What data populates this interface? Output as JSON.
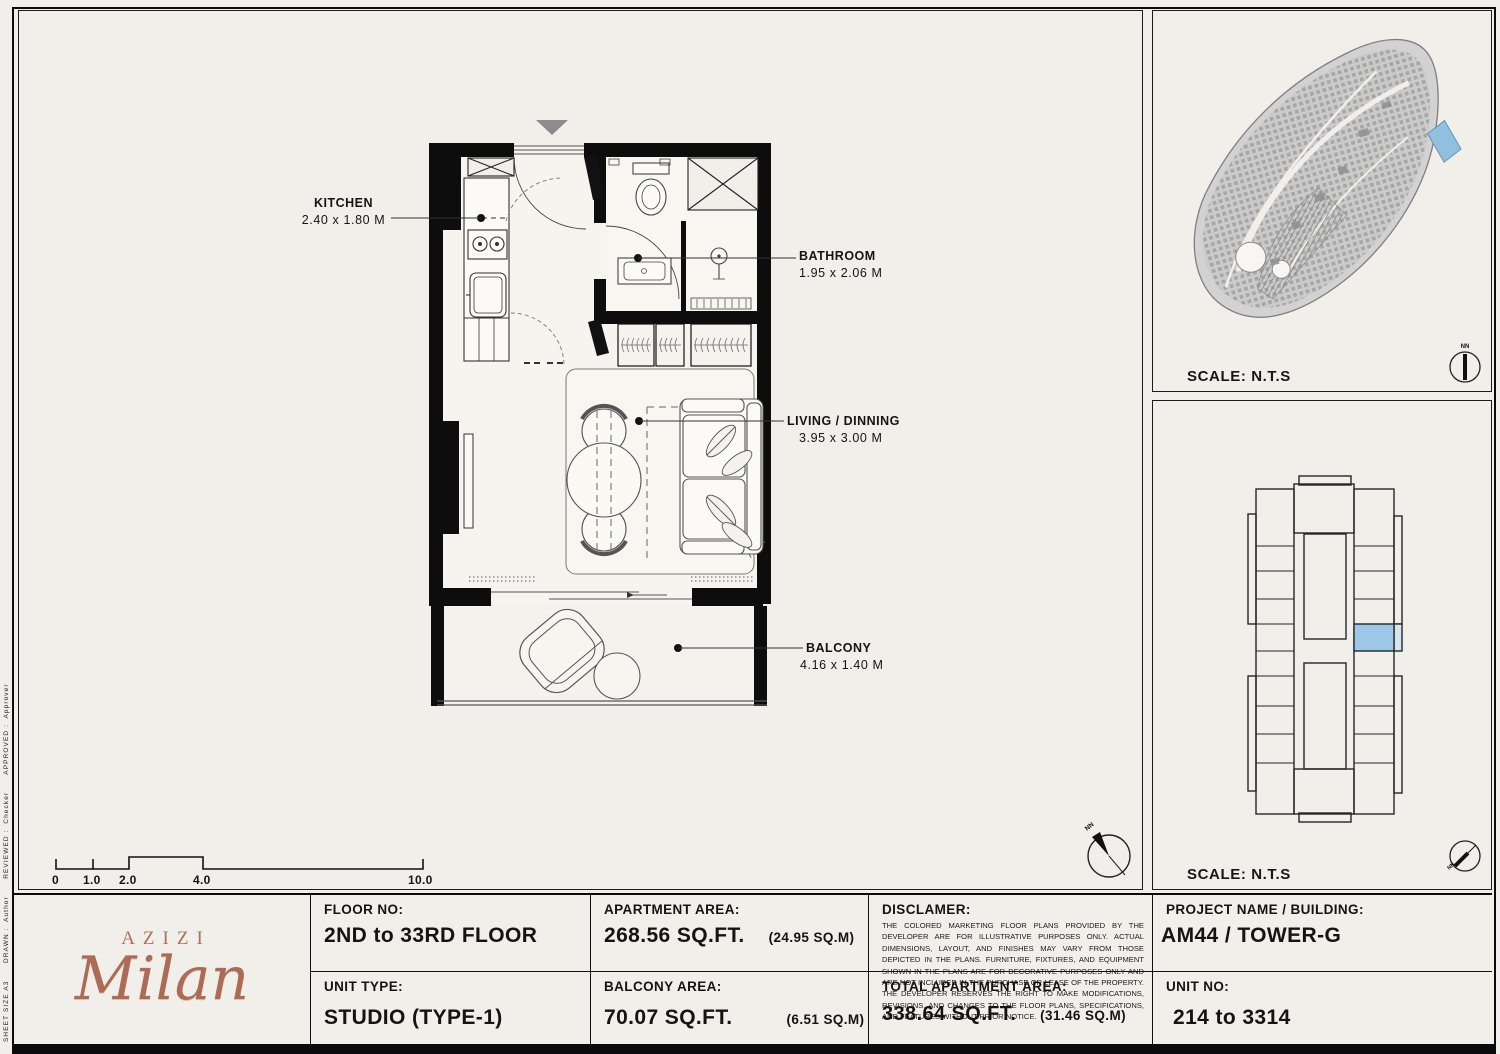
{
  "sheet": {
    "side_note": "SHEET SIZE A3      DRAWN :  Author      REVIEWED :  Checker      APPROVED :  Approver"
  },
  "plan": {
    "callouts": [
      {
        "name": "KITCHEN",
        "dims": "2.40 x 1.80 M"
      },
      {
        "name": "BATHROOM",
        "dims": "1.95 x 2.06 M"
      },
      {
        "name": "LIVING / DINNING",
        "dims": "3.95 x 3.00 M"
      },
      {
        "name": "BALCONY",
        "dims": "4.16 x 1.40 M"
      }
    ],
    "scale_bar": {
      "ticks": [
        "0",
        "1.0",
        "2.0",
        "4.0",
        "10.0"
      ]
    },
    "compass_label": "NN"
  },
  "site_plan": {
    "scale_label": "SCALE: N.T.S",
    "compass_label": "NN",
    "highlight_color": "#8fc0e0"
  },
  "key_plan": {
    "scale_label": "SCALE: N.T.S",
    "compass_label": "NN",
    "highlight_color": "#9dc8e8"
  },
  "title_block": {
    "logo": {
      "brand": "AZIZI",
      "name": "Milan"
    },
    "floor": {
      "label": "FLOOR NO:",
      "value": "2ND to 33RD FLOOR"
    },
    "unit_type": {
      "label": "UNIT TYPE:",
      "value": "STUDIO (TYPE-1)"
    },
    "apartment_area": {
      "label": "APARTMENT AREA:",
      "value": "268.56 SQ.FT.",
      "metric": "(24.95 SQ.M)"
    },
    "balcony_area": {
      "label": "BALCONY AREA:",
      "value": "70.07 SQ.FT.",
      "metric": "(6.51 SQ.M)"
    },
    "disclaimer": {
      "label": "DISCLAMER:",
      "text": "THE COLORED MARKETING FLOOR PLANS PROVIDED BY THE DEVELOPER ARE FOR ILLUSTRATIVE PURPOSES ONLY. ACTUAL DIMENSIONS, LAYOUT, AND FINISHES MAY VARY FROM THOSE DEPICTED IN THE PLANS. FURNITURE, FIXTURES, AND EQUIPMENT SHOWN IN THE PLANS ARE FOR DECORATIVE PURPOSES ONLY AND ARE NOT INCLUDED IN THE PURCHASE OR LEASE OF THE PROPERTY. THE DEVELOPER RESERVES THE RIGHT TO MAKE MODIFICATIONS, REVISIONS, AND CHANGES TO THE FLOOR PLANS, SPECIFICATIONS, AND FEATURES WITHOUT PRIOR NOTICE."
    },
    "total_area": {
      "label": "TOTAL APARTMENT AREA:",
      "value": "338.64 SQ.FT.",
      "metric": "(31.46 SQ.M)"
    },
    "project": {
      "label": "PROJECT NAME / BUILDING:",
      "value": "AM44 / TOWER-G"
    },
    "unit_no": {
      "label": "UNIT NO:",
      "value": "214 to 3314"
    }
  }
}
